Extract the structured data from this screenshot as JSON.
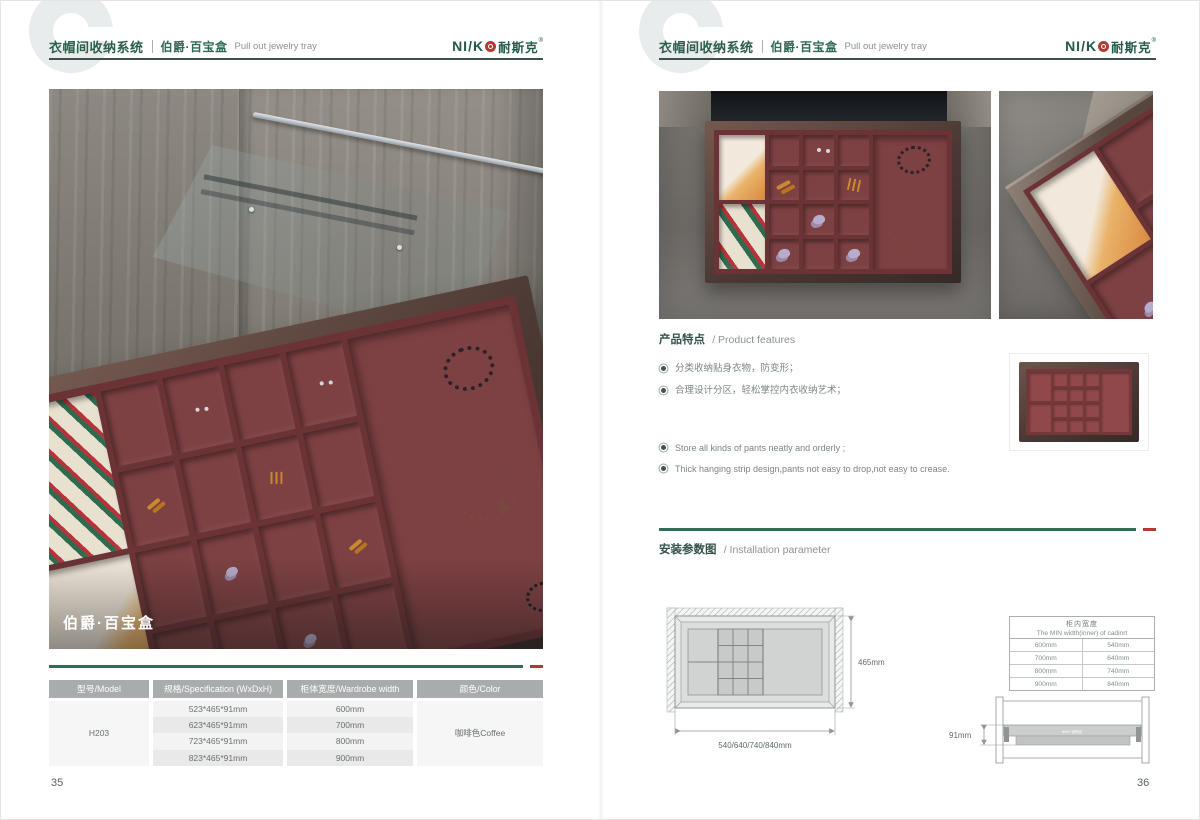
{
  "colors": {
    "brand_green": "#2e6e55",
    "accent_red": "#b23a33",
    "header_rule": "#3d4f49",
    "tray_burgundy": "#7e4143",
    "frame_brown": "#4b3835",
    "table_header_bg": "#a9acac",
    "diagram_line": "#8f9695"
  },
  "header": {
    "watermark": "C",
    "title_cn": "衣帽间收纳系统",
    "subtitle_cn": "伯爵·百宝盒",
    "subtitle_en": "Pull out jewelry tray",
    "logo_prefix": "NI/K",
    "logo_cn": "耐斯克",
    "reg": "®",
    "logo_emboss": "NI/KO 耐斯克"
  },
  "left_page": {
    "photo_label": "伯爵·百宝盒",
    "page_number": "35",
    "table": {
      "headers": [
        "型号/Model",
        "规格/Specification (WxDxH)",
        "柜体宽度/Wardrobe width",
        "颜色/Color"
      ],
      "model": "H203",
      "rows": [
        {
          "spec": "523*465*91mm",
          "width": "600mm"
        },
        {
          "spec": "623*465*91mm",
          "width": "700mm"
        },
        {
          "spec": "723*465*91mm",
          "width": "800mm"
        },
        {
          "spec": "823*465*91mm",
          "width": "900mm"
        }
      ],
      "color": "咖啡色Coffee"
    }
  },
  "right_page": {
    "page_number": "36",
    "features": {
      "heading_cn": "产品特点",
      "heading_en": "/ Product features",
      "bullets_cn": [
        "分类收纳贴身衣物，防变形；",
        "合理设计分区，轻松掌控内衣收纳艺术；"
      ],
      "bullets_en": [
        "Store all kinds of pants neatly and orderly ;",
        "Thick hanging strip design,pants not easy to drop,not easy to crease."
      ]
    },
    "installation": {
      "heading_cn": "安装参数图",
      "heading_en": "/ Installation parameter",
      "top_view": {
        "depth_label": "465mm",
        "width_label": "540/640/740/840mm"
      },
      "side_view": {
        "height_label": "91mm"
      },
      "width_table": {
        "title_cn": "柜内宽度",
        "title_en": "The MIN width(inner) of cadinrt",
        "rows": [
          {
            "wardrobe": "600mm",
            "inner": "540mm"
          },
          {
            "wardrobe": "700mm",
            "inner": "640mm"
          },
          {
            "wardrobe": "800mm",
            "inner": "740mm"
          },
          {
            "wardrobe": "900mm",
            "inner": "840mm"
          }
        ]
      }
    }
  }
}
